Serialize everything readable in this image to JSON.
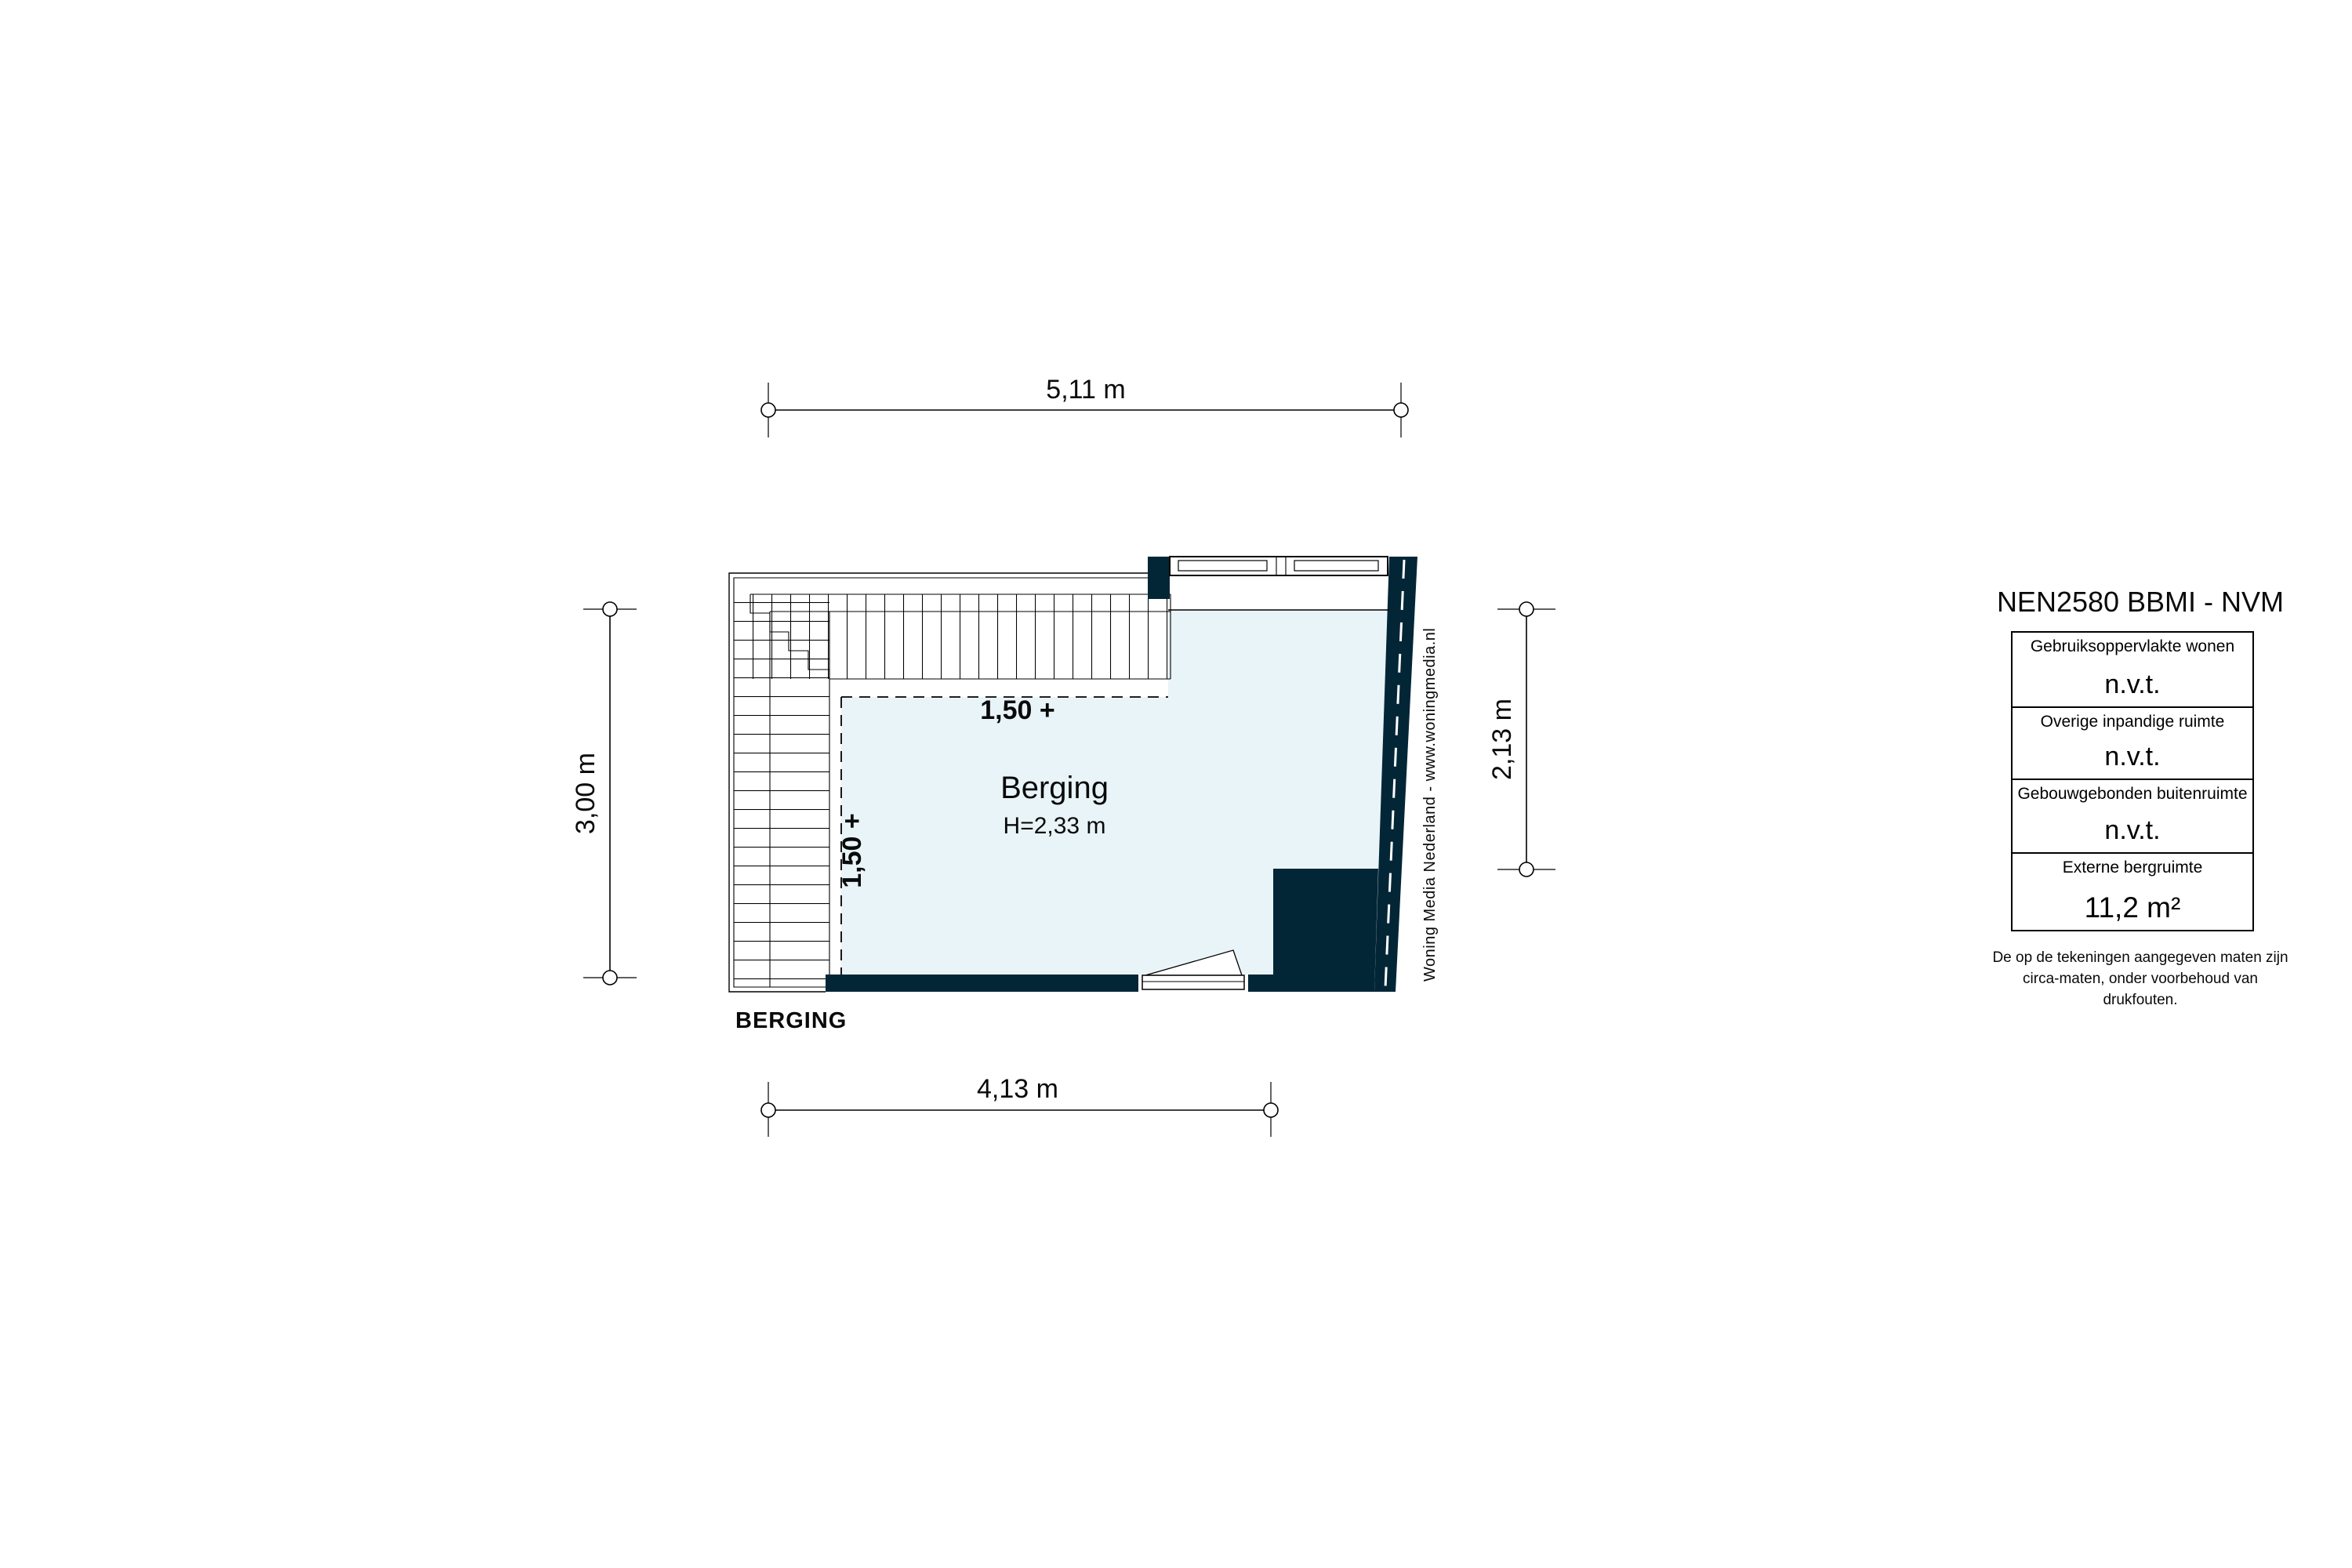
{
  "floor_plan": {
    "room": {
      "name": "Berging",
      "height_label": "H=2,33 m"
    },
    "plan_caption": "BERGING",
    "height_contour": {
      "horizontal_label": "1,50 +",
      "vertical_label": "1,50 +"
    },
    "dimensions": {
      "top": "5,11 m",
      "bottom": "4,13 m",
      "left": "3,00 m",
      "right": "2,13 m"
    },
    "watermark": "Woning Media Nederland - www.woningmedia.nl"
  },
  "panel": {
    "title": "NEN2580 BBMI - NVM",
    "rows": [
      {
        "label": "Gebruiksoppervlakte wonen",
        "value": "n.v.t."
      },
      {
        "label": "Overige inpandige ruimte",
        "value": "n.v.t."
      },
      {
        "label": "Gebouwgebonden buitenruimte",
        "value": "n.v.t."
      },
      {
        "label": "Externe bergruimte",
        "value": "11,2 m²"
      }
    ],
    "disclaimer": [
      "De op de tekeningen aangegeven maten zijn",
      "circa-maten, onder voorbehoud van drukfouten."
    ]
  },
  "colors": {
    "wall": "#032637",
    "room_fill": "#e9f4f8",
    "line": "#000000"
  }
}
